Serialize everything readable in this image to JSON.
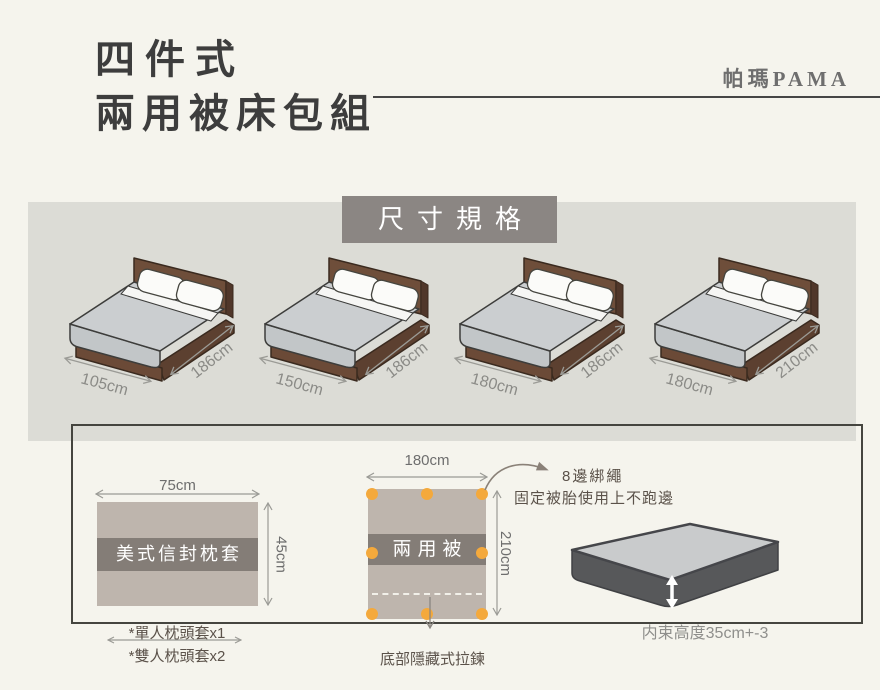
{
  "header": {
    "title_line1": "四件式",
    "title_line2": "兩用被床包組",
    "brand": "帕瑪PAMA"
  },
  "spec_panel": {
    "title": "尺寸規格",
    "beds": [
      {
        "width": "105cm",
        "length": "186cm"
      },
      {
        "width": "150cm",
        "length": "186cm"
      },
      {
        "width": "180cm",
        "length": "186cm"
      },
      {
        "width": "180cm",
        "length": "210cm"
      }
    ]
  },
  "pillowcase": {
    "width_label": "75cm",
    "height_label": "45cm",
    "band_label": "美式信封枕套",
    "note_single": "*單人枕頭套x1",
    "note_double": "*雙人枕頭套x2"
  },
  "quilt": {
    "width_label": "180cm",
    "height_label": "210cm",
    "band_label": "兩用被",
    "tie_title": "8邊綁繩",
    "tie_desc": "固定被胎使用上不跑邊",
    "zipper_note": "底部隱藏式拉鍊"
  },
  "mattress": {
    "height_note": "内束高度35cm+-3"
  },
  "colors": {
    "page_bg": "#f5f4ed",
    "panel_bg": "#dcdcd6",
    "label_bg": "#8b8683",
    "fabric_taupe": "#beb5ad",
    "band_gray": "#847d77",
    "dot_orange": "#f4a93c",
    "ink_dark": "#3d3d3d",
    "ink_gray": "#6e6e6e",
    "ink_brown": "#5b524a",
    "dim_gray": "#8b8b87"
  }
}
